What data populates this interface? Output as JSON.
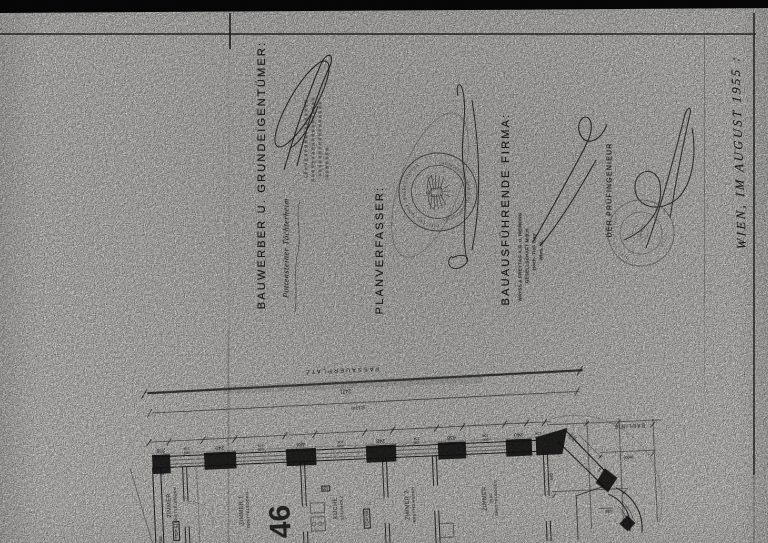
{
  "titles": {
    "bauwerber": "BAUWERBER U. GRUNDEIGENTÜMER:",
    "planverfasser": "PLANVERFASSER:",
    "firma": "BAUAUSFÜHRENDE FIRMA:",
    "pruefingenieur": "DER PRÜFINGENIEUR",
    "date_note": "WIEN, IM AUGUST 1955 :"
  },
  "handwriting": {
    "bauwerber_owner": "Pottensteiner Töchterheim"
  },
  "stamps": {
    "architect_seal": {
      "top_arc": "DIPL. ING. ERNST LEDERER-PONZER",
      "bottom_arc": "STAATL. BEFUGTER U. BEEIDETER ARCHITEKT · WIEN"
    },
    "firma_stamp": {
      "line1": "WAYSS & FREYTAG A.G. u. MEINONG",
      "line2": "GESELLSCHAFT M.B.H.",
      "line3": "Hoch- Tief- Bau",
      "line4": "Wien, IX."
    },
    "pruef_seal": {
      "top_arc": "DIPL. ING. HUGO",
      "bottom_arc": "WIEN"
    }
  },
  "plan": {
    "street": "PASSAUERPLATZ",
    "bauline": "BAULINIE",
    "dim_total": "2421",
    "dim_total_paren": "(2124)",
    "house_number": "46",
    "rooms": {
      "r1_tag": "TOP 61",
      "r1_name": "ZIMMER",
      "r1_floor": "BRETTELBODEN",
      "r2_name": "ZIMMER 1",
      "r2_floor": "BRETTELBODEN",
      "r3_name": "KÜCHE",
      "r3_floor": "STEINHOLZ",
      "r3_note": "165",
      "r4_tag": "TOP 60",
      "r4_name": "ZIMMER 2",
      "r4_floor": "BRETTELBODEN",
      "r5_name": "ZIMMER",
      "r5_floor": "BRETTELBODEN",
      "r5_area": "36.92"
    },
    "chain": [
      "120\n124",
      "240",
      "100\n104",
      "438",
      "150\n154",
      "248",
      "100\n104",
      "484",
      "120\n124",
      "240",
      "190\n194",
      "208"
    ],
    "side_dims": {
      "s640": "640",
      "s600": "(600)",
      "s484": "484",
      "bay1": "240\n244",
      "bay2": "240\n244",
      "end_h": "584",
      "end_t": "38"
    }
  }
}
